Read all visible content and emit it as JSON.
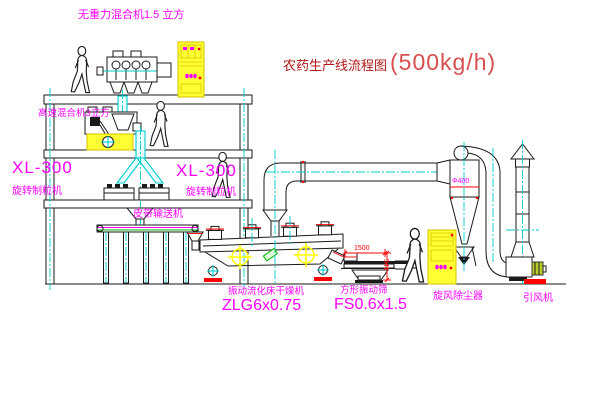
{
  "title": {
    "text": "农药生产线流程图",
    "capacity": "(500kg/h)"
  },
  "labels": {
    "weightless_mixer": "无重力混合机1.5 立方",
    "high_speed_mixer": "高速混合机3立方",
    "left_granulator_model": "XL-300",
    "left_granulator_name": "旋转制粒机",
    "right_granulator_model": "XL-300",
    "right_granulator_name": "旋转制粒机",
    "belt_conveyor": "皮带输送机",
    "fluid_bed_dryer_name": "振动流化床干燥机",
    "fluid_bed_dryer_model": "ZLG6x0.75",
    "vibrating_screen_name": "方形振动筛",
    "vibrating_screen_model": "FS0.6x1.5",
    "cyclone": "旋风除尘器",
    "induced_draft_fan": "引风机",
    "cyclone_size": "Φ400"
  },
  "dimensions": {
    "screen_width": "1500",
    "screen_height": "541"
  },
  "colors": {
    "line": "#1a1a1a",
    "centerline": "#00cccc",
    "label": "#ff00ff",
    "dimension": "#ff0000",
    "highlight": "#ffff33",
    "title_text": "#b01818",
    "title_capacity": "#d94f4f",
    "green": "#00b400"
  }
}
